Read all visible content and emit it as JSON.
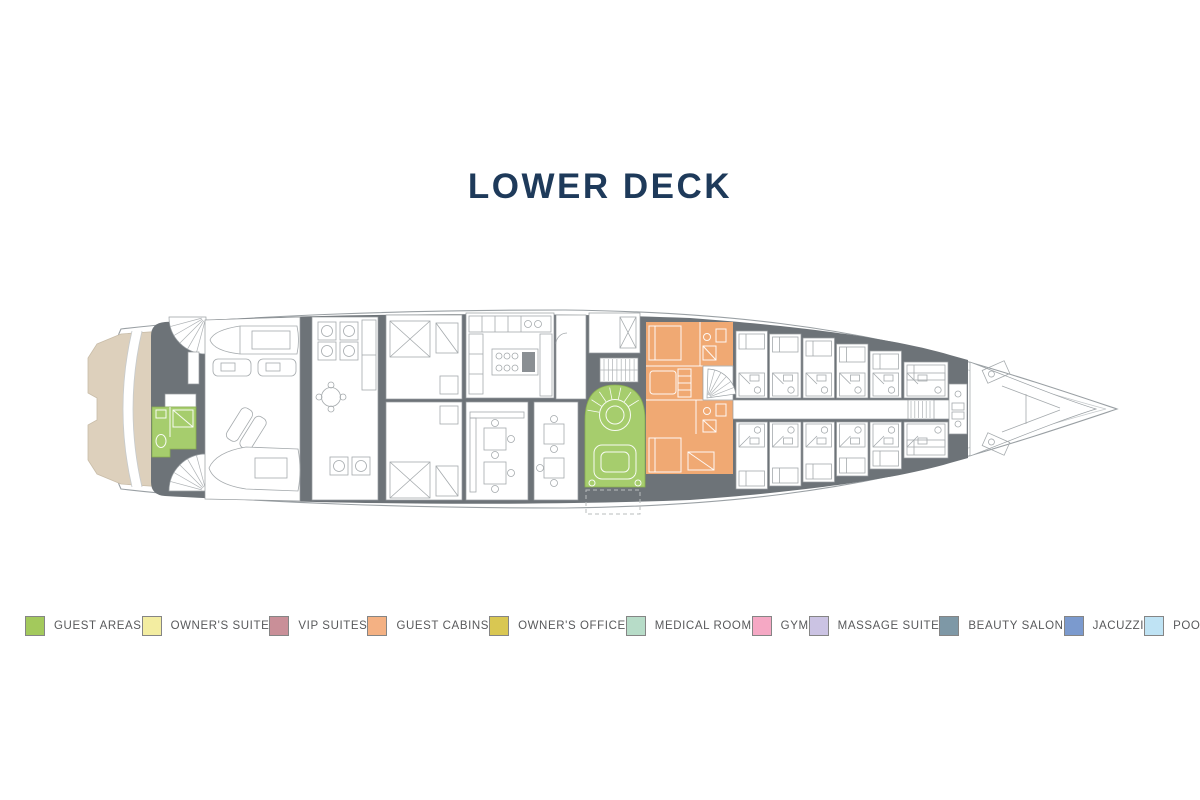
{
  "title": "LOWER DECK",
  "legend": [
    {
      "label": "GUEST AREAS",
      "color": "#a3c95c"
    },
    {
      "label": "OWNER'S SUITE",
      "color": "#f3eda1"
    },
    {
      "label": "VIP SUITES",
      "color": "#c98f98"
    },
    {
      "label": "GUEST CABINS",
      "color": "#f4b183"
    },
    {
      "label": "OWNER'S OFFICE",
      "color": "#d9c752"
    },
    {
      "label": "MEDICAL ROOM",
      "color": "#b7dcc8"
    },
    {
      "label": "GYM",
      "color": "#f5a8c4"
    },
    {
      "label": "MASSAGE SUITE",
      "color": "#cbc3e3"
    },
    {
      "label": "BEAUTY SALON",
      "color": "#7e98a6"
    },
    {
      "label": "JACUZZI",
      "color": "#7b9ace"
    },
    {
      "label": "POOL",
      "color": "#bfe3f4"
    }
  ],
  "plan": {
    "deck_name": "LOWER DECK",
    "highlighted_areas": [
      {
        "type": "GUEST AREAS",
        "color": "#a6cd6d",
        "location": "beach club bathroom at stern"
      },
      {
        "type": "GUEST AREAS",
        "color": "#a6cd6d",
        "location": "midship lobby with spiral staircase"
      },
      {
        "type": "GUEST CABINS",
        "color": "#f0a973",
        "location": "two guest cabins aft of crew quarters"
      }
    ]
  },
  "colors": {
    "title": "#1e3a5a",
    "legendText": "#58595b",
    "hullLine": "#9aa0a4",
    "hullLineLight": "#c6cacc",
    "deckGray": "#6d7378",
    "furn": "#a5aaad",
    "beige": "#ddd0bc",
    "green": "#a6cd6d",
    "greenStroke": "#8ab04f",
    "orange": "#f0a973",
    "dashed": "#b9bcbe"
  }
}
